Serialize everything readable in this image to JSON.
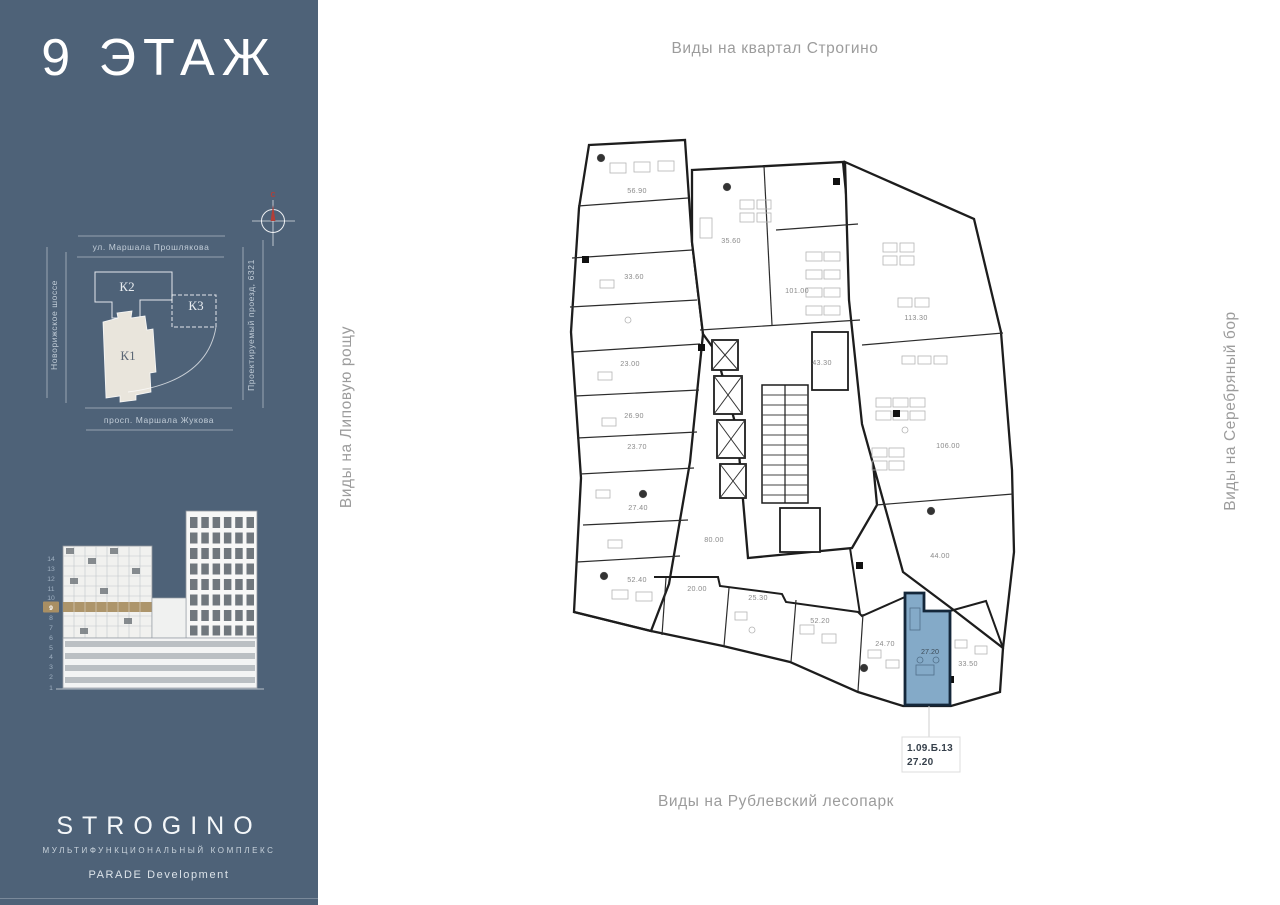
{
  "sidebar": {
    "floor_title": "9 ЭТАЖ",
    "compass": {
      "north_label": "С"
    },
    "site_plan": {
      "street_top": "ул. Маршала Прошлякова",
      "street_left": "Новорижское шоссе",
      "street_right": "Проектируемый проезд, 6321",
      "street_bottom": "просп. Маршала Жукова",
      "buildings": {
        "k1": "К1",
        "k2": "К2",
        "k3": "К3"
      }
    },
    "elevation": {
      "floors": [
        "14",
        "13",
        "12",
        "11",
        "10",
        "9",
        "8",
        "7",
        "6",
        "5",
        "4",
        "3",
        "2",
        "1"
      ],
      "highlighted_floor": "9"
    },
    "logo": {
      "brand": "STROGINO",
      "subtitle": "МУЛЬТИФУНКЦИОНАЛЬНЫЙ КОМПЛЕКС",
      "developer": "PARADE Development"
    }
  },
  "plan": {
    "view_labels": {
      "top": "Виды на квартал Строгино",
      "bottom": "Виды на Рублевский лесопарк",
      "left": "Виды на Липовую рощу",
      "right": "Виды на Серебряный бор"
    },
    "rooms": [
      {
        "area": "56.90"
      },
      {
        "area": "35.60"
      },
      {
        "area": "33.60"
      },
      {
        "area": "101.00"
      },
      {
        "area": "113.30"
      },
      {
        "area": "43.30"
      },
      {
        "area": "23.00"
      },
      {
        "area": "26.90"
      },
      {
        "area": "23.70"
      },
      {
        "area": "27.40"
      },
      {
        "area": "106.00"
      },
      {
        "area": "80.00"
      },
      {
        "area": "44.00"
      },
      {
        "area": "52.40"
      },
      {
        "area": "20.00"
      },
      {
        "area": "25.30"
      },
      {
        "area": "52.20"
      },
      {
        "area": "24.70"
      },
      {
        "area": "27.20"
      },
      {
        "area": "33.50"
      }
    ],
    "selected_unit": {
      "id": "1.09.Б.13",
      "area": "27.20"
    }
  },
  "colors": {
    "sidebar_bg": "#4e6278",
    "selected_unit_fill": "#84aac8",
    "selected_unit_border": "#14273a",
    "floor_highlight": "#a98f63",
    "compass_north": "#b23f38",
    "k1_fill": "#e9e5dc"
  }
}
